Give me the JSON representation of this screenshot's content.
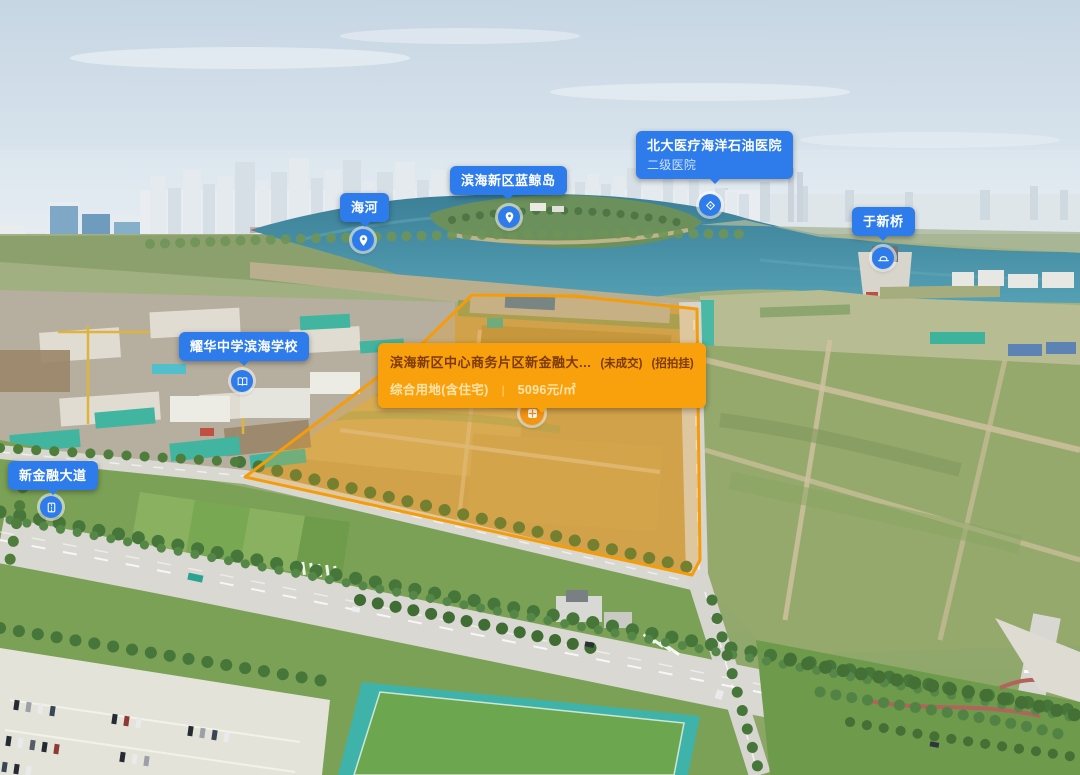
{
  "app": {
    "view": "aerial-land-parcel-map",
    "colors": {
      "poi_label_blue": "#2e7cec",
      "poi_subtitle_blue": "#cfe2fd",
      "parcel_card_orange": "#f9a10c",
      "parcel_title_brown": "#7c3a00",
      "parcel_subtitle_cream": "#ffe4ad",
      "parcel_boundary_stroke": "#f59c0b",
      "marker_blue": "#2e7cec",
      "marker_orange": "#f59312"
    }
  },
  "map_labels": {
    "haihe": {
      "text": "海河",
      "icon": "location-pin-icon"
    },
    "blue_whale_island": {
      "text": "滨海新区蓝鲸岛",
      "icon": "location-pin-icon"
    },
    "hospital": {
      "text": "北大医疗海洋石油医院",
      "subtitle": "二级医院",
      "icon": "diamond-marker-icon"
    },
    "yuxin_bridge": {
      "text": "于新桥",
      "icon": "bridge-icon"
    },
    "school": {
      "text": "耀华中学滨海学校",
      "icon": "school-icon"
    },
    "new_finance_avenue": {
      "text": "新金融大道",
      "icon": "road-icon"
    }
  },
  "parcel_card": {
    "title": "滨海新区中心商务片区新金融大...",
    "tag_1": "(未成交)",
    "tag_2": "(招拍挂)",
    "land_use": "综合用地(含住宅)",
    "divider": "|",
    "price": "5096元/㎡",
    "icon": "parcel-grid-icon"
  }
}
